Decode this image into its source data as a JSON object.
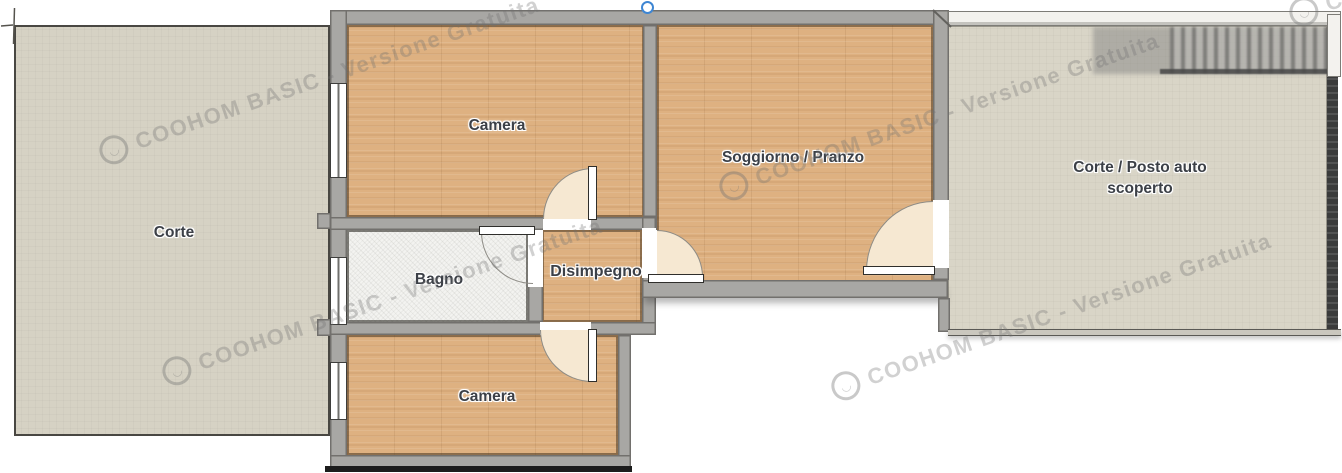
{
  "app": {
    "name": "floor-plan-editor",
    "watermark": {
      "text": "COOHOM BASIC - Versione Gratuita",
      "logo": "coohom-logo"
    }
  },
  "rooms": {
    "corte_left": "Corte",
    "camera_top": "Camera",
    "soggiorno": "Soggiorno / Pranzo",
    "bagno": "Bagno",
    "disimpegno": "Disimpegno",
    "camera_bottom": "Camera",
    "corte_right_line1": "Corte / Posto auto",
    "corte_right_line2": "scoperto"
  },
  "colors": {
    "wall_gray": "#a8a7a4",
    "wood_floor": "#deb181",
    "tile_floor": "#f3f3f0",
    "courtyard": "#d6d2c4",
    "door_swing": "#f6e8d2",
    "label_text": "#3c4047",
    "selection_handle_blue": "#3e86d3",
    "dark_fence": "#1c1c1c"
  }
}
